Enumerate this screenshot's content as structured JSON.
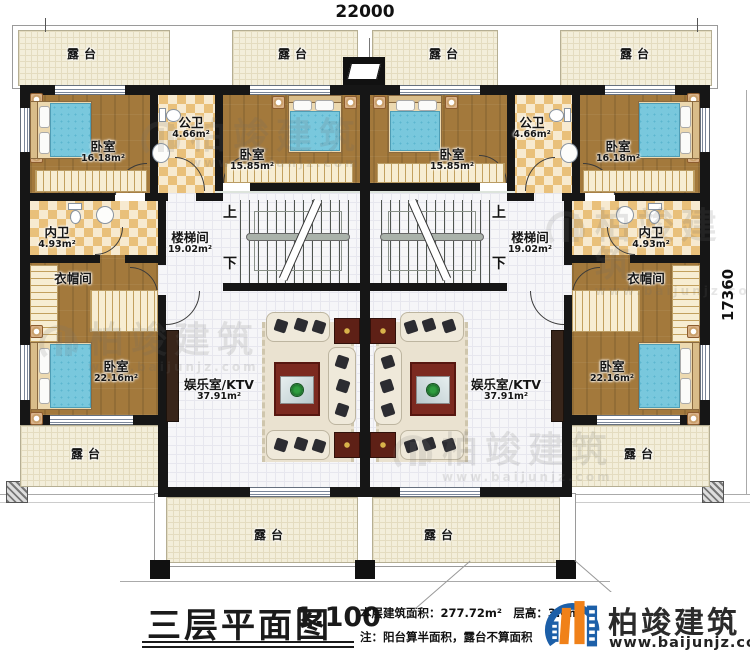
{
  "dimensions": {
    "width": "22000",
    "height": "17360"
  },
  "plan": {
    "terrace": "露台",
    "stair_up": "上",
    "stair_down": "下",
    "left_unit": {
      "bedroom_top_left": {
        "name": "卧室",
        "area": "16.18m²"
      },
      "public_bath": {
        "name": "公卫",
        "area": "4.66m²"
      },
      "bedroom_top_right": {
        "name": "卧室",
        "area": "15.85m²"
      },
      "private_bath": {
        "name": "内卫",
        "area": "4.93m²"
      },
      "cloakroom": {
        "name": "衣帽间"
      },
      "bedroom_master": {
        "name": "卧室",
        "area": "22.16m²"
      },
      "stairwell": {
        "name": "楼梯间",
        "area": "19.02m²"
      },
      "ktv": {
        "name": "娱乐室/KTV",
        "area": "37.91m²"
      }
    },
    "right_unit": {
      "bedroom_top_left": {
        "name": "卧室",
        "area": "15.85m²"
      },
      "public_bath": {
        "name": "公卫",
        "area": "4.66m²"
      },
      "bedroom_top_right": {
        "name": "卧室",
        "area": "16.18m²"
      },
      "private_bath": {
        "name": "内卫",
        "area": "4.93m²"
      },
      "cloakroom": {
        "name": "衣帽间"
      },
      "bedroom_master": {
        "name": "卧室",
        "area": "22.16m²"
      },
      "stairwell": {
        "name": "楼梯间",
        "area": "19.02m²"
      },
      "ktv": {
        "name": "娱乐室/KTV",
        "area": "37.91m²"
      }
    }
  },
  "title_block": {
    "title": "三层平面图",
    "scale": "1:100",
    "area_line": "本层建筑面积：277.72m²　层高：3.0m",
    "note_line": "注：阳台算半面积，露台不算面积"
  },
  "brand": {
    "name": "柏竣建筑",
    "url": "www.baijunjz.com"
  },
  "watermark": {
    "name": "柏竣建筑",
    "url": "www.baijunjz.com"
  },
  "colors": {
    "wall": "#161616",
    "wood_floor": "#a3793c",
    "bath_tile": "#e9c07a",
    "terrace_floor": "#f3eeda",
    "bed": "#79c8dd",
    "ktv_rug": "#7c2a20",
    "brand_blue": "#1c5fa8",
    "brand_orange": "#f08119"
  }
}
